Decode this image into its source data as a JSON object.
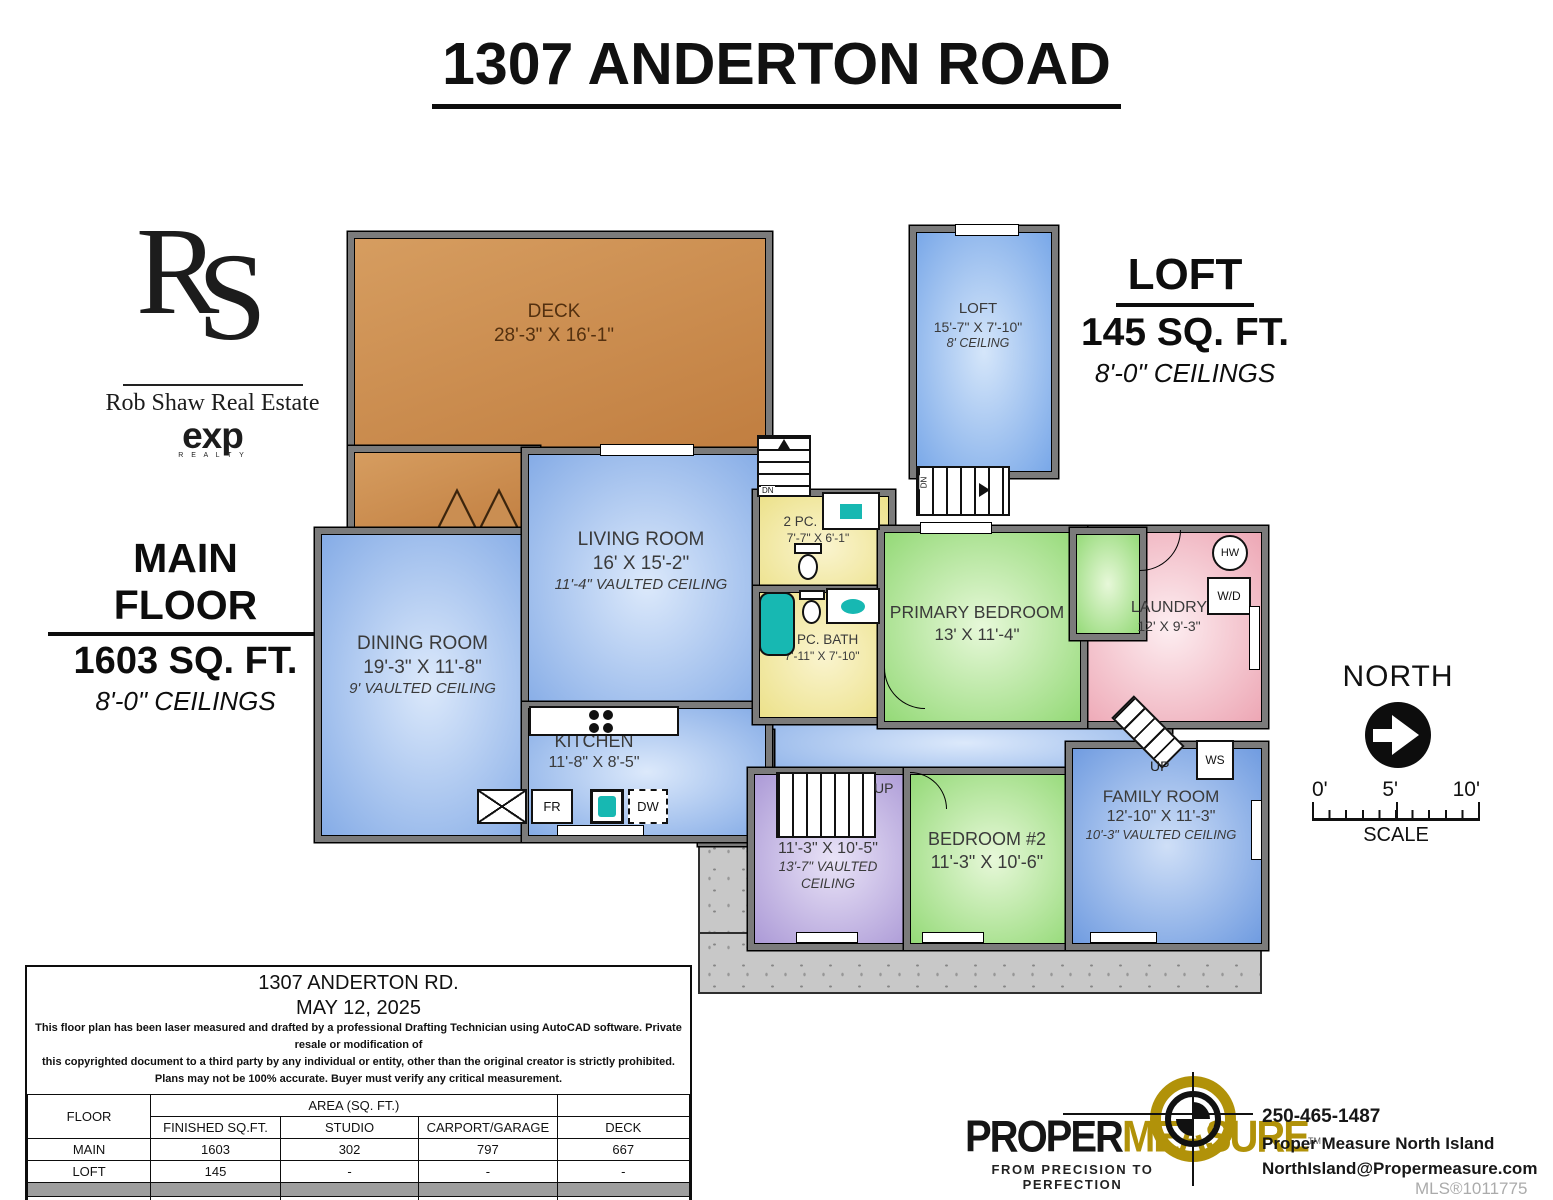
{
  "title": "1307 ANDERTON ROAD",
  "branding": {
    "monogram_r": "R",
    "monogram_s": "S",
    "agency": "Rob Shaw Real Estate",
    "brokerage": "exp",
    "brokerage_sub": "R E A L T Y"
  },
  "headings": {
    "main_floor": {
      "name": "MAIN FLOOR",
      "area": "1603 SQ. FT.",
      "ceilings": "8'-0\" CEILINGS"
    },
    "loft": {
      "name": "LOFT",
      "area": "145 SQ. FT.",
      "ceilings": "8'-0\" CEILINGS"
    }
  },
  "rooms": {
    "deck": {
      "name": "DECK",
      "dims": "28'-3\" X 16'-1\""
    },
    "loft": {
      "name": "LOFT",
      "dims": "15'-7\" X 7'-10\"",
      "ceiling": "8' CEILING"
    },
    "living_room": {
      "name": "LIVING ROOM",
      "dims": "16' X 15'-2\"",
      "ceiling": "11'-4\" VAULTED CEILING"
    },
    "dining_room": {
      "name": "DINING ROOM",
      "dims": "19'-3\" X 11'-8\"",
      "ceiling": "9' VAULTED CEILING"
    },
    "kitchen": {
      "name": "KITCHEN",
      "dims": "11'-8\" X 8'-5\""
    },
    "ensuite": {
      "name": "2 PC. ENS.",
      "dims": "7'-7\" X 6'-1\""
    },
    "bath": {
      "name": "4 PC. BATH",
      "dims": "7'-11\" X 7'-10\""
    },
    "primary_bedroom": {
      "name": "PRIMARY BEDROOM",
      "dims": "13' X 11'-4\""
    },
    "laundry": {
      "name": "LAUNDRY",
      "dims": "12' X 9'-3\""
    },
    "entry": {
      "name": "ENTRY",
      "dims": "5'-2\" X 3'-11\""
    },
    "den": {
      "name": "DEN",
      "dims": "11'-3\" X 10'-5\"",
      "ceiling": "13'-7\" VAULTED CEILING"
    },
    "bedroom_2": {
      "name": "BEDROOM #2",
      "dims": "11'-3\" X 10'-6\""
    },
    "family_room": {
      "name": "FAMILY ROOM",
      "dims": "12'-10\" X 11'-3\"",
      "ceiling": "10'-3\" VAULTED CEILING"
    }
  },
  "plan_labels": {
    "dn": "DN",
    "up": "UP",
    "fridge": "FR",
    "dishwasher": "DW",
    "hot_water": "HW",
    "washer_dryer": "W/D",
    "water_softener": "WS"
  },
  "compass": {
    "label": "NORTH"
  },
  "scale_bar": {
    "tick_0": "0'",
    "tick_5": "5'",
    "tick_10": "10'",
    "label": "SCALE"
  },
  "info_table": {
    "address": "1307 ANDERTON RD.",
    "date": "MAY 12, 2025",
    "disclaimer": [
      "This floor plan has been laser measured and drafted by a professional Drafting Technician using AutoCAD software. Private resale or modification of",
      "this copyrighted document to a third party by any individual or entity, other than the original creator is strictly prohibited.",
      "Plans may not be 100% accurate.  Buyer must verify any critical measurement."
    ],
    "floor_header": "FLOOR",
    "area_header": "AREA (SQ. FT.)",
    "columns": [
      "FINISHED SQ.FT.",
      "STUDIO",
      "CARPORT/GARAGE",
      "DECK"
    ],
    "rows": [
      {
        "floor": "MAIN",
        "finished": "1603",
        "studio": "302",
        "carport": "797",
        "deck": "667"
      },
      {
        "floor": "LOFT",
        "finished": "145",
        "studio": "-",
        "carport": "-",
        "deck": "-"
      }
    ],
    "total": {
      "floor": "TOTAL",
      "finished": "1748",
      "studio": "302",
      "carport": "797",
      "deck": "667"
    }
  },
  "footer": {
    "logo_primary": "PROPER",
    "logo_secondary": "MEASURE",
    "logo_tm": "TM",
    "tagline": "FROM PRECISION TO PERFECTION",
    "phone": "250-465-1487",
    "company": "Proper Measure North Island",
    "email": "NorthIsland@Propermeasure.com",
    "mls": "MLS®1011775"
  },
  "colors": {
    "deck_orange": "#c68a4f",
    "room_blue": "#85aee8",
    "room_green": "#9ade7e",
    "room_yellow": "#efe48e",
    "room_pink": "#efa9b6",
    "room_purple": "#b4a3de",
    "wall_gray": "#7b7b7b",
    "fixture_teal": "#17b8b2",
    "brand_gold": "#b19209"
  }
}
